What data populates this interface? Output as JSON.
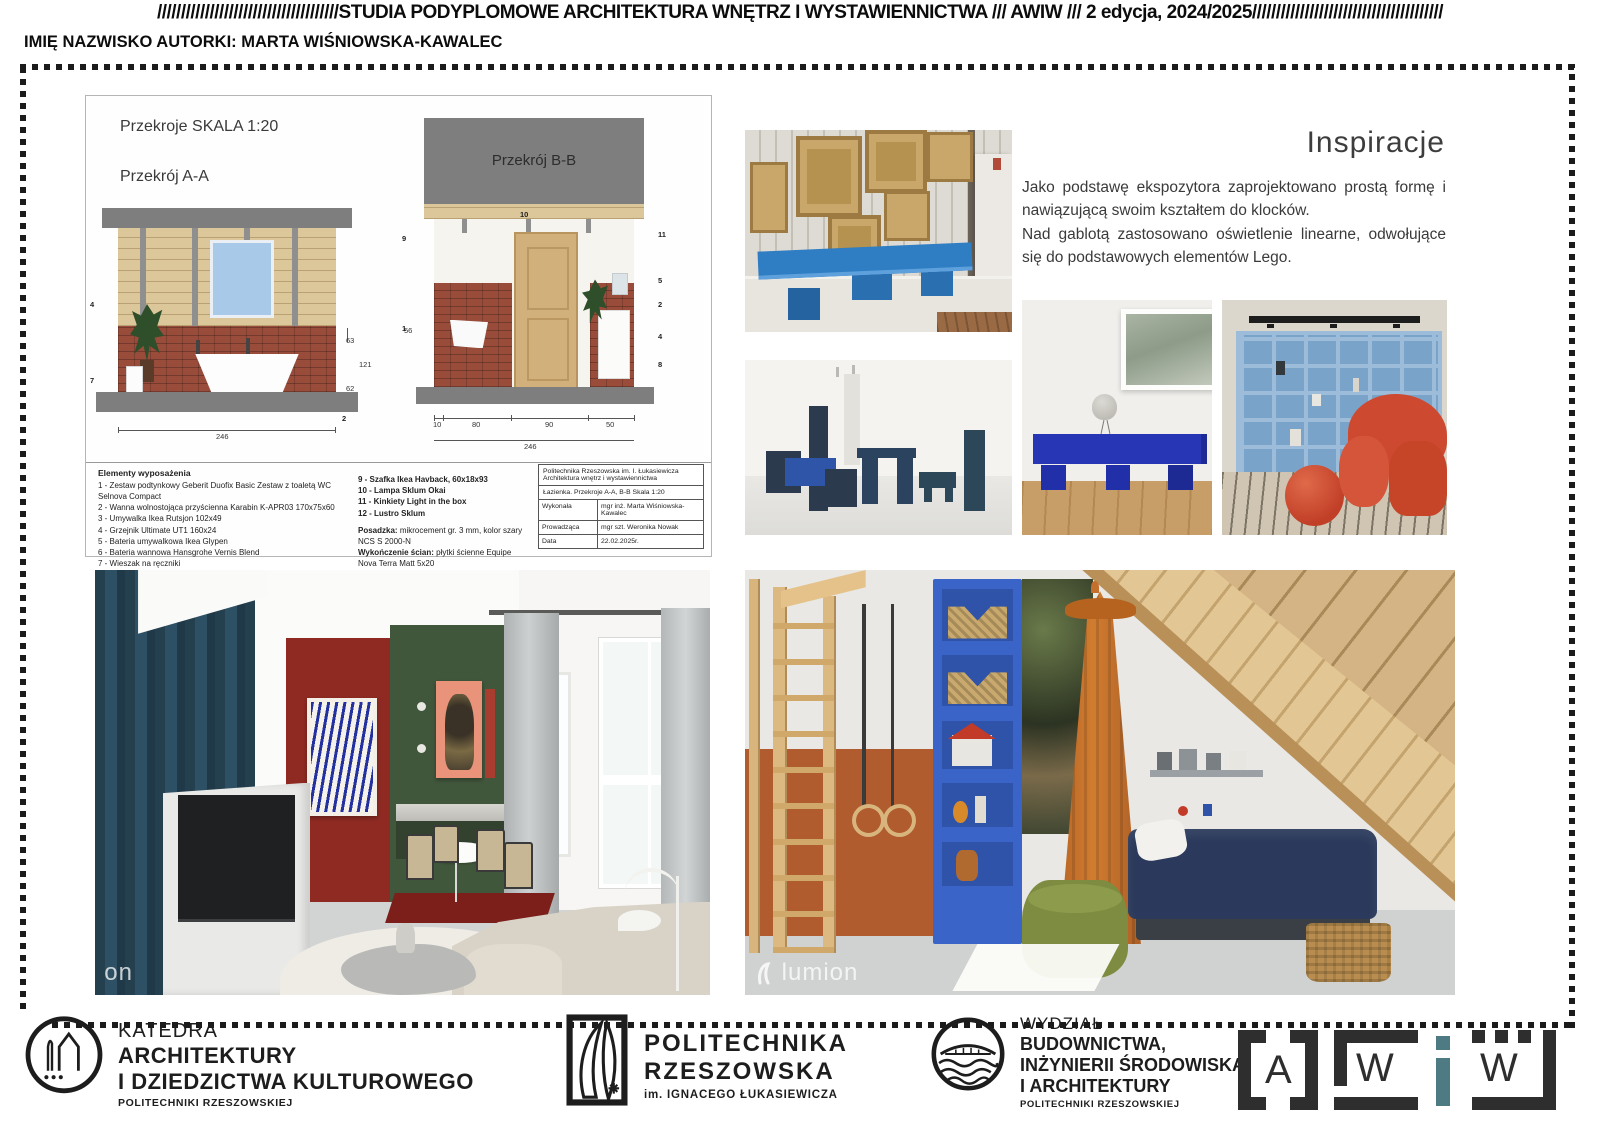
{
  "header": {
    "line1_prefix": "//////////////////////////////////////",
    "line1_title": "STUDIA PODYPLOMOWE ARCHITEKTURA WNĘTRZ I WYSTAWIENNICTWA /// AWIW /// 2 edycja, 2024/2025",
    "line1_suffix": "////////////////////////////////////////",
    "line2": "IMIĘ NAZWISKO AUTORKI: MARTA WIŚNIOWSKA-KAWALEC"
  },
  "drawings": {
    "sheet_title": "Przekroje SKALA 1:20",
    "section_a_label": "Przekrój A-A",
    "section_b_label": "Przekrój B-B",
    "dims": {
      "aa_total_width": "246",
      "aa_h1": "63",
      "aa_h2": "121",
      "aa_h3": "62",
      "bb_seg1": "10",
      "bb_seg2": "80",
      "bb_seg3": "90",
      "bb_seg4": "50",
      "bb_total": "246",
      "bb_left_height": "56"
    },
    "callouts": {
      "aa": [
        "4",
        "7",
        "2"
      ],
      "bb_top": "10",
      "bb_left1": "9",
      "bb_left2": "1",
      "bb_right": [
        "11",
        "5",
        "2",
        "4",
        "8"
      ]
    },
    "legend": {
      "title": "Elementy wyposażenia",
      "items_left": [
        "1 - Zestaw podtynkowy Geberit Duofix Basic Zestaw z toaletą WC Selnova Compact",
        "2 - Wanna wolnostojąca przyścienna Karabin K-APR03 170x75x60",
        "3 - Umywalka Ikea Rutsjon 102x49",
        "4 - Grzejnik Ultimate UT1 160x24",
        "5 - Bateria umywalkowa Ikea Glypen",
        "6 - Bateria wannowa Hansgrohe Vernis Blend",
        "7 - Wieszak na ręczniki",
        "8 - Szafka pod umywalkę Ikea Havback, 100x48x63"
      ],
      "items_right": [
        "9 - Szafka Ikea Havback, 60x18x93",
        "10 - Lampa Sklum Okai",
        "11 - Kinkiety Light in the box",
        "12 - Lustro Sklum"
      ],
      "finish1_label": "Posadzka:",
      "finish1_text": "mikrocement gr. 3 mm, kolor szary NCS S 2000-N",
      "finish2_label": "Wykończenie ścian:",
      "finish2_text": "płytki ścienne Equipe Nova Terra Matt 5x20",
      "finish3_text": "ściany malowane farbą kolor biały NCS 0500-N"
    },
    "titleblock": {
      "org1": "Politechnika Rzeszowska im. I. Łukasiewicza",
      "org2": "Architektura wnętrz i wystawiennictwa",
      "subject": "Łazienka. Przekroje A-A, B-B Skala 1:20",
      "rows": [
        {
          "label": "Wykonała",
          "value": "mgr inż. Marta Wiśniowska-Kawalec"
        },
        {
          "label": "Prowadząca",
          "value": "mgr szt. Weronika Nowak"
        },
        {
          "label": "Data",
          "value": "22.02.2025r."
        }
      ]
    }
  },
  "inspiration": {
    "heading": "Inspiracje",
    "para1": "Jako podstawę ekspozytora zaprojektowano prostą formę i nawiązującą swoim kształtem do klocków.",
    "para2": "Nad gablotą zastosowano oświetlenie linearne, odwołujące się do podstawowych elementów Lego."
  },
  "renders": {
    "living_watermark": "on",
    "kids_watermark": "lumion"
  },
  "footer": {
    "katedra": {
      "l1": "KATEDRA",
      "l2": "ARCHITEKTURY",
      "l3": "I DZIEDZICTWA KULTUROWEGO",
      "l4": "POLITECHNIKI RZESZOWSKIEJ"
    },
    "prz": {
      "l1": "POLITECHNIKA",
      "l2": "RZESZOWSKA",
      "l3": "im. IGNACEGO ŁUKASIEWICZA"
    },
    "wydzial": {
      "l1": "WYDZIAŁ",
      "l2": "BUDOWNICTWA,",
      "l3": "INŻYNIERII ŚRODOWISKA",
      "l4": "I ARCHITEKTURY",
      "l5": "POLITECHNIKI RZESZOWSKIEJ"
    },
    "awiw": {
      "a": "A",
      "w1": "W",
      "i": "i",
      "w2": "W"
    }
  },
  "colors": {
    "bench_blue": "#2f7dc2",
    "cobalt": "#2736b4",
    "shelf_lightblue": "#8fb2d5",
    "kids_shelf_blue": "#3a64c8",
    "chair_red": "#cd4a30",
    "canopy_orange": "#c4702c",
    "wall_red": "#8e2a22",
    "wall_green": "#41573c",
    "curtain_teal": "#2b4557",
    "rust_wall": "#b05c2e",
    "pouf_green": "#7d8c40",
    "awiw_teal": "#4e7a83"
  }
}
